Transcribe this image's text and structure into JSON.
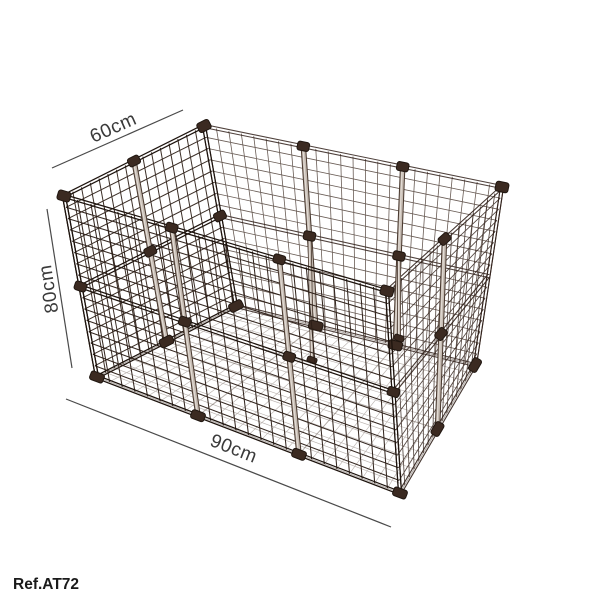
{
  "canvas": {
    "width": 600,
    "height": 600,
    "background": "#ffffff"
  },
  "product": {
    "kind": "modular wire grid pet playpen",
    "panels": {
      "width_panels": 3,
      "depth_panels": 2,
      "height_panels": 2,
      "cells_per_panel": 8
    },
    "colors": {
      "wire_front": "#2b1e16",
      "wire_left": "#32241b",
      "wire_back": "#44332a",
      "wire_right": "#362720",
      "wire_floor": "#55443a",
      "frame_near": "#1d130d",
      "frame_far": "#30201a",
      "connector": "#3b2a21",
      "connector_edge": "#1f1610",
      "post_core": "#c6bcb3",
      "post_edge": "#4a3a30",
      "post_highlight": "#eae4de"
    }
  },
  "annotations": {
    "line_color": "#4a4a4a",
    "text_color": "#3a3a3a",
    "depth": {
      "label": "60cm"
    },
    "height": {
      "label": "80cm"
    },
    "width": {
      "label": "90cm"
    }
  },
  "footer": {
    "ref_label": "Ref.AT72",
    "color": "#1a1a1a"
  }
}
